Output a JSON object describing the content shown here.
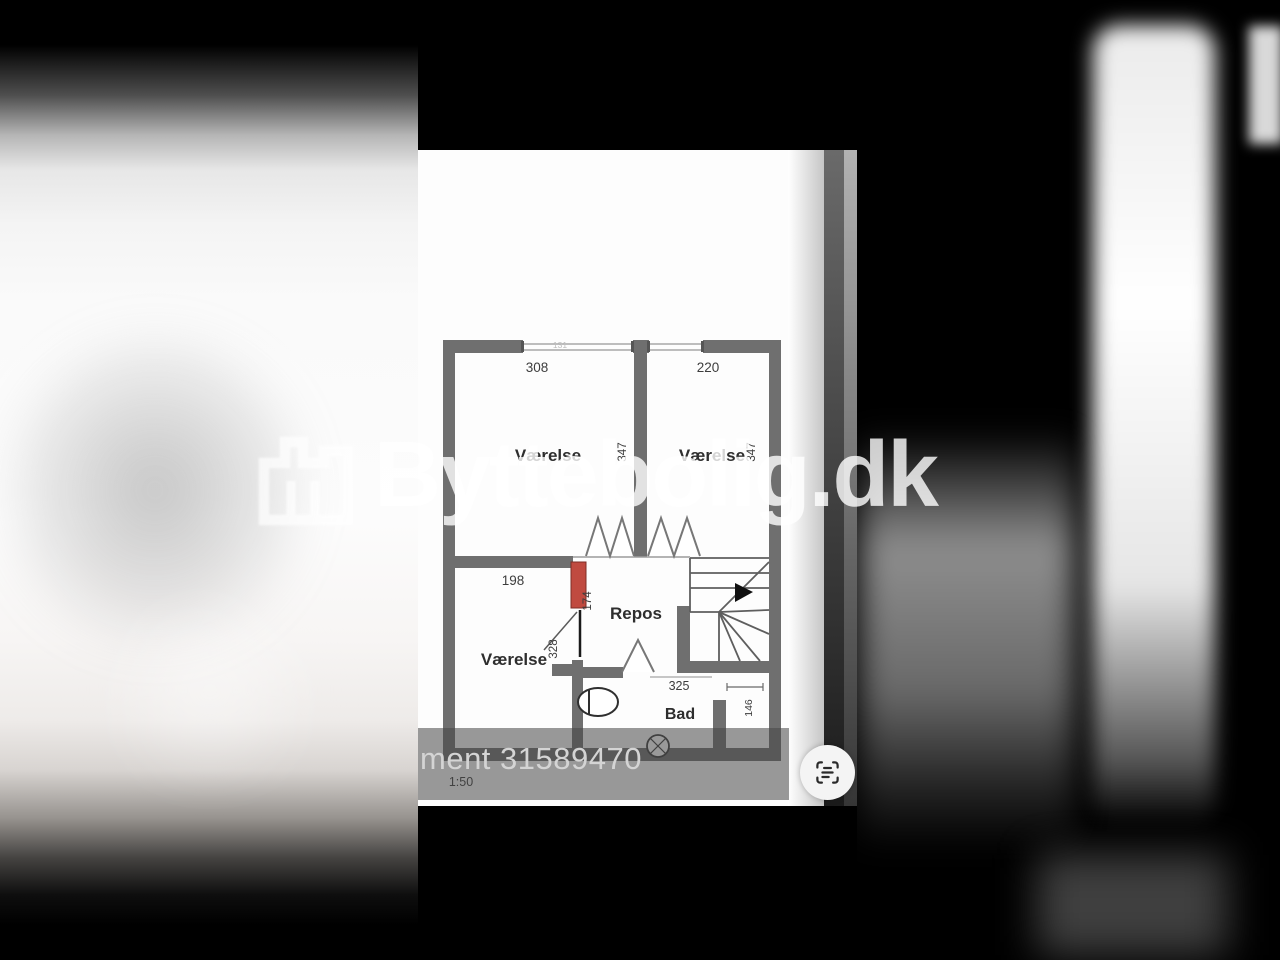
{
  "watermark": {
    "text": "Byttebolig.dk",
    "icon": "building-icon",
    "color": "#ffffff"
  },
  "caption": {
    "text": "ment 31589470"
  },
  "controls": {
    "scan_button_icon": "scan-text-icon"
  },
  "floorplan": {
    "scale": "1:50",
    "wall_color": "#6f6f6f",
    "highlight_color": "#c04a40",
    "labels": {
      "room1_name": "Værelse",
      "room1_width": "308",
      "room1_depth": "347",
      "room2_name": "Værelse",
      "room2_width": "220",
      "room2_depth": "347",
      "room3_name": "Værelse",
      "room3_width": "198",
      "room3_depth": "328",
      "repos_name": "Repos",
      "repos_door_width": "174",
      "bad_name": "Bad",
      "bad_width": "325",
      "bad_niche_depth": "146",
      "window_width": "131"
    }
  }
}
